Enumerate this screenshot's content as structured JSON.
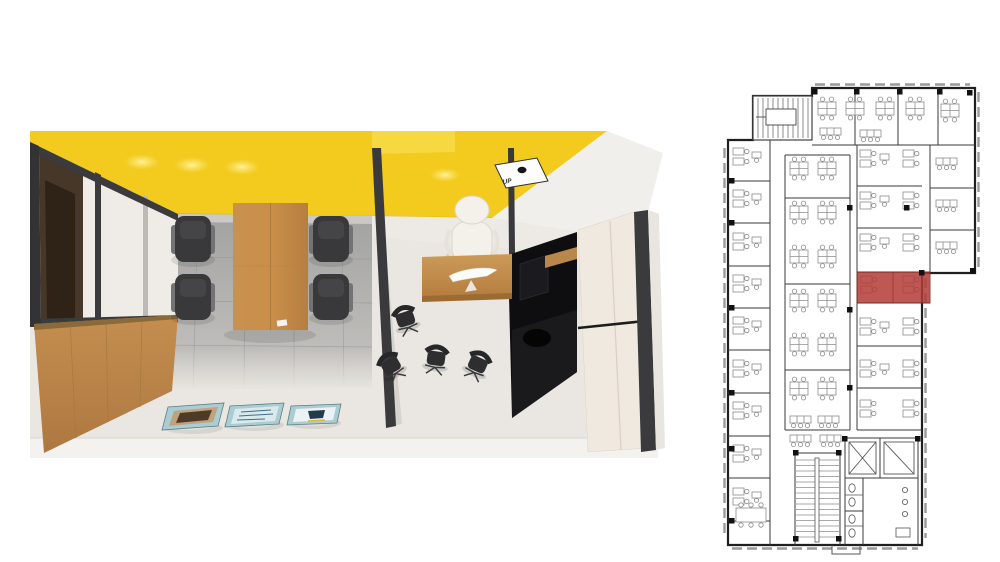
{
  "render": {
    "up_sign_label": "UP",
    "colors": {
      "ceiling_yellow": "#F2CB1E",
      "ceiling_step": "#F7DC4C",
      "ceiling_glow": "#FFE975",
      "wall_white": "#F1EFEC",
      "partition_panel": "#EFECE7",
      "frame_dark": "#3B3A3C",
      "opening_brown": "#473728",
      "wood": "#C0894C",
      "wood_light": "#CD9A58",
      "tile_gray": "#A9A8A6",
      "floor_light": "#EAE7E2",
      "floor_strip": "#F4F2EF",
      "chair_dark": "#39383B",
      "chair_arm": "#737375",
      "exec_chair": "#F4F1EB",
      "black_gloss": "#0E0E10",
      "cream_panel": "#F0E9E0",
      "poster_teal": "#A9CDD2",
      "poster_brown": "#4E3B27",
      "poster_pale": "#D9E9EC",
      "poster_navy": "#223A49",
      "poster_yellow": "#D9B93F"
    }
  },
  "floor_plan": {
    "outline_color": "#1F1F1F",
    "wall_color": "#3A3A3A",
    "furniture_color": "#8C8C8C",
    "window_color": "#9A9A9A",
    "column_color": "#111111",
    "highlight_color": "#B23B38",
    "highlight_room": {
      "x": 157,
      "y": 194,
      "w": 73,
      "h": 31
    },
    "walls": [
      [
        70,
        62,
        70,
        467
      ],
      [
        28,
        103,
        70,
        103
      ],
      [
        28,
        145,
        70,
        145
      ],
      [
        28,
        188,
        70,
        188
      ],
      [
        28,
        230,
        70,
        230
      ],
      [
        28,
        272,
        70,
        272
      ],
      [
        28,
        315,
        70,
        315
      ],
      [
        28,
        358,
        70,
        358
      ],
      [
        28,
        400,
        70,
        400
      ],
      [
        28,
        443,
        70,
        443
      ],
      [
        112,
        67,
        275,
        67
      ],
      [
        155,
        10,
        155,
        67
      ],
      [
        198,
        10,
        198,
        67
      ],
      [
        238,
        10,
        238,
        67
      ],
      [
        85,
        77,
        85,
        352
      ],
      [
        150,
        77,
        150,
        352
      ],
      [
        85,
        77,
        150,
        77
      ],
      [
        85,
        352,
        150,
        352
      ],
      [
        85,
        120,
        150,
        120
      ],
      [
        85,
        206,
        150,
        206
      ],
      [
        85,
        292,
        150,
        292
      ],
      [
        157,
        67,
        157,
        352
      ],
      [
        157,
        352,
        222,
        352
      ],
      [
        157,
        108,
        222,
        108
      ],
      [
        157,
        150,
        222,
        150
      ],
      [
        157,
        194,
        230,
        194
      ],
      [
        157,
        225,
        230,
        225
      ],
      [
        157,
        268,
        222,
        268
      ],
      [
        157,
        310,
        222,
        310
      ],
      [
        193,
        194,
        193,
        225
      ],
      [
        230,
        67,
        230,
        195
      ],
      [
        230,
        110,
        275,
        110
      ],
      [
        230,
        152,
        275,
        152
      ],
      [
        95,
        375,
        95,
        467
      ],
      [
        140,
        375,
        140,
        467
      ],
      [
        95,
        375,
        140,
        375
      ],
      [
        145,
        360,
        218,
        360
      ],
      [
        145,
        360,
        145,
        400
      ],
      [
        218,
        360,
        218,
        400
      ],
      [
        145,
        400,
        218,
        400
      ],
      [
        180,
        360,
        180,
        400
      ],
      [
        145,
        400,
        145,
        467
      ],
      [
        218,
        400,
        218,
        467
      ],
      [
        163,
        400,
        163,
        467
      ],
      [
        145,
        433,
        163,
        433
      ]
    ],
    "clusters": [
      {
        "t": "quad",
        "x": 118,
        "y": 24
      },
      {
        "t": "quad",
        "x": 146,
        "y": 24
      },
      {
        "t": "quad",
        "x": 176,
        "y": 24
      },
      {
        "t": "quad",
        "x": 206,
        "y": 24
      },
      {
        "t": "quad",
        "x": 241,
        "y": 26
      },
      {
        "t": "row3",
        "x": 120,
        "y": 50
      },
      {
        "t": "row3",
        "x": 160,
        "y": 52
      },
      {
        "t": "pairV",
        "x": 33,
        "y": 70
      },
      {
        "t": "pairV",
        "x": 33,
        "y": 112
      },
      {
        "t": "pairV",
        "x": 33,
        "y": 155
      },
      {
        "t": "pairV",
        "x": 33,
        "y": 197
      },
      {
        "t": "pairV",
        "x": 33,
        "y": 239
      },
      {
        "t": "pairV",
        "x": 33,
        "y": 282
      },
      {
        "t": "pairV",
        "x": 33,
        "y": 324
      },
      {
        "t": "pairV",
        "x": 33,
        "y": 367
      },
      {
        "t": "pairV",
        "x": 33,
        "y": 410
      },
      {
        "t": "single",
        "x": 52,
        "y": 74
      },
      {
        "t": "single",
        "x": 52,
        "y": 116
      },
      {
        "t": "single",
        "x": 52,
        "y": 159
      },
      {
        "t": "single",
        "x": 52,
        "y": 201
      },
      {
        "t": "single",
        "x": 52,
        "y": 243
      },
      {
        "t": "single",
        "x": 52,
        "y": 286
      },
      {
        "t": "single",
        "x": 52,
        "y": 328
      },
      {
        "t": "single",
        "x": 52,
        "y": 371
      },
      {
        "t": "single",
        "x": 52,
        "y": 414
      },
      {
        "t": "quad",
        "x": 90,
        "y": 84
      },
      {
        "t": "quad",
        "x": 118,
        "y": 84
      },
      {
        "t": "quad",
        "x": 90,
        "y": 128
      },
      {
        "t": "quad",
        "x": 118,
        "y": 128
      },
      {
        "t": "quad",
        "x": 90,
        "y": 172
      },
      {
        "t": "quad",
        "x": 118,
        "y": 172
      },
      {
        "t": "quad",
        "x": 90,
        "y": 216
      },
      {
        "t": "quad",
        "x": 118,
        "y": 216
      },
      {
        "t": "quad",
        "x": 90,
        "y": 260
      },
      {
        "t": "quad",
        "x": 118,
        "y": 260
      },
      {
        "t": "quad",
        "x": 90,
        "y": 304
      },
      {
        "t": "quad",
        "x": 118,
        "y": 304
      },
      {
        "t": "row3",
        "x": 90,
        "y": 338
      },
      {
        "t": "row3",
        "x": 118,
        "y": 338
      },
      {
        "t": "row3",
        "x": 90,
        "y": 357
      },
      {
        "t": "row3",
        "x": 120,
        "y": 357
      },
      {
        "t": "pairV",
        "x": 160,
        "y": 72
      },
      {
        "t": "pairV",
        "x": 203,
        "y": 72
      },
      {
        "t": "single",
        "x": 180,
        "y": 76
      },
      {
        "t": "pairV",
        "x": 160,
        "y": 114
      },
      {
        "t": "pairV",
        "x": 203,
        "y": 114
      },
      {
        "t": "single",
        "x": 180,
        "y": 118
      },
      {
        "t": "pairV",
        "x": 160,
        "y": 156
      },
      {
        "t": "pairV",
        "x": 203,
        "y": 156
      },
      {
        "t": "single",
        "x": 180,
        "y": 160
      },
      {
        "t": "pairV",
        "x": 161,
        "y": 198
      },
      {
        "t": "pairV",
        "x": 203,
        "y": 198
      },
      {
        "t": "pairV",
        "x": 160,
        "y": 240
      },
      {
        "t": "pairV",
        "x": 203,
        "y": 240
      },
      {
        "t": "single",
        "x": 180,
        "y": 244
      },
      {
        "t": "pairV",
        "x": 160,
        "y": 282
      },
      {
        "t": "pairV",
        "x": 203,
        "y": 282
      },
      {
        "t": "single",
        "x": 180,
        "y": 286
      },
      {
        "t": "pairV",
        "x": 160,
        "y": 322
      },
      {
        "t": "pairV",
        "x": 203,
        "y": 322
      },
      {
        "t": "row3",
        "x": 236,
        "y": 80
      },
      {
        "t": "row3",
        "x": 236,
        "y": 122
      },
      {
        "t": "row3",
        "x": 236,
        "y": 164
      },
      {
        "t": "meeting",
        "x": 36,
        "y": 430
      }
    ],
    "columns": [
      [
        112,
        11
      ],
      [
        154,
        11
      ],
      [
        197,
        11
      ],
      [
        237,
        11
      ],
      [
        267,
        12
      ],
      [
        29,
        100
      ],
      [
        29,
        142
      ],
      [
        29,
        227
      ],
      [
        29,
        312
      ],
      [
        29,
        368
      ],
      [
        29,
        440
      ],
      [
        147,
        127
      ],
      [
        147,
        229
      ],
      [
        147,
        307
      ],
      [
        204,
        127
      ],
      [
        93,
        372
      ],
      [
        136,
        372
      ],
      [
        142,
        358
      ],
      [
        215,
        358
      ],
      [
        93,
        458
      ],
      [
        136,
        458
      ],
      [
        219,
        192
      ],
      [
        270,
        190
      ]
    ]
  }
}
